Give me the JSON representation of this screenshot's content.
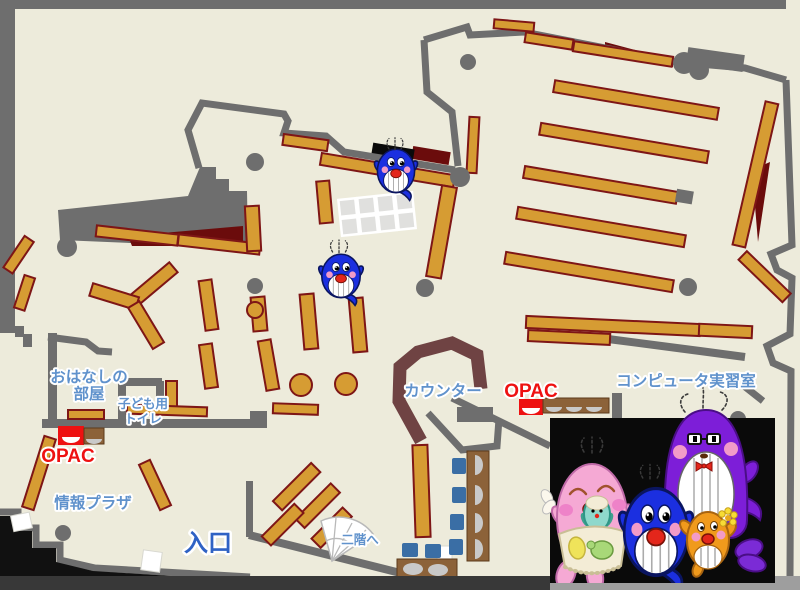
{
  "map": {
    "name": "library-first-floor-map",
    "labels": {
      "storytelling_room": {
        "line1": "おはなしの",
        "line2": "部屋"
      },
      "kids_toilet": {
        "line1": "子ども用",
        "line2": "トイレ"
      },
      "opac_left": "OPAC",
      "opac_right": "OPAC",
      "info_plaza": "情報プラザ",
      "entrance": "入口",
      "stairs_to_2f": "二階へ",
      "counter": "カウンター",
      "computer_room": "コンピュータ実習室"
    },
    "mascots": {
      "map_sprites": [
        "blue-whale-small",
        "blue-whale-small"
      ],
      "family_photo": [
        "pink-whale-parent",
        "baby-teal-whale",
        "blue-whale-child",
        "purple-whale-parent",
        "orange-whale-child"
      ]
    }
  },
  "colors": {
    "floor": "#EDEBDB",
    "wall": "#6E6E6E",
    "shelf": "#D69C33",
    "shelf-border": "#7E1616",
    "maroon": "#6B0C0C",
    "counter": "#6F4343",
    "label-blue": "#6092CC",
    "entrance-blue": "#2F62C4",
    "opac-red": "#EE1111",
    "chair-blue": "#3A6EA5",
    "desk-brown": "#8C6239",
    "seat-gray": "#C9C9C9",
    "black-box": "#0A0A0A",
    "strip-dark": "#383838",
    "strip-light": "#9E9E9E",
    "grid-cell": "#E0E0DE",
    "whale-blue": "#1B2FE0",
    "whale-navy": "#0A1560",
    "whale-pink": "#F5A9D4",
    "whale-purple": "#7D1ED8",
    "whale-orange": "#F09A1C",
    "baby-teal": "#8FD8CC",
    "cheek-pink": "#F29BC8",
    "mouth-red": "#E3261B",
    "flower-yellow": "#F7DC35",
    "apron-cream": "#F3ECD6"
  }
}
